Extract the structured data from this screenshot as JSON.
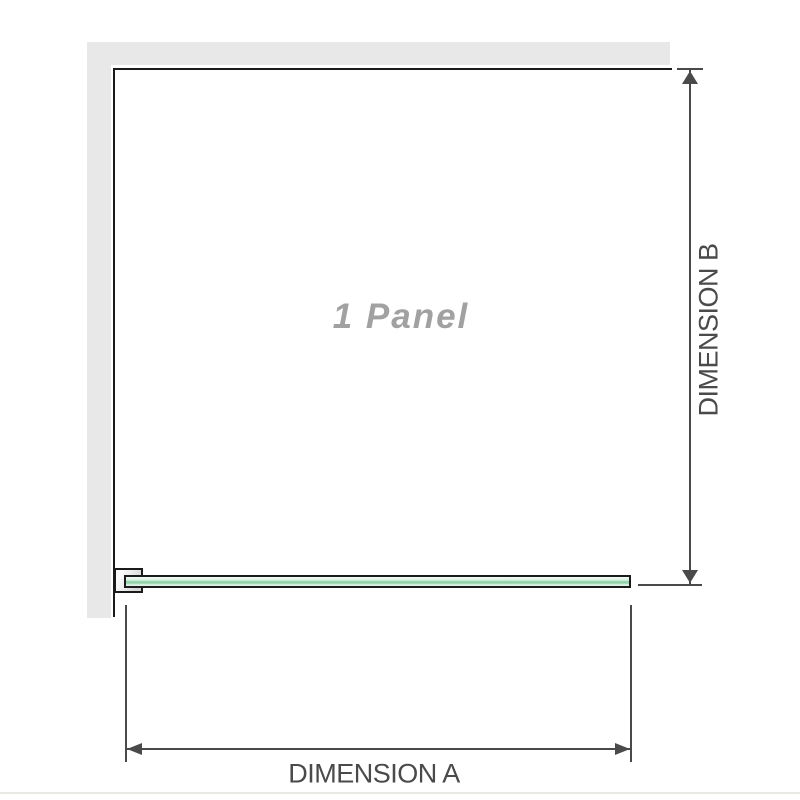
{
  "diagram": {
    "panel_count_label": "1 Panel",
    "dimension_a": {
      "label": "DIMENSION A"
    },
    "dimension_b": {
      "label": "DIMENSION B"
    },
    "colors": {
      "bg": "#ffffff",
      "wall": "#e8e8e8",
      "outline": "#1b1b1b",
      "dimension": "#4a4a4a",
      "panel_text": "#a1a1a1",
      "glass_dark": "#90d3a9",
      "bottom_rule": "#eae8e4"
    }
  }
}
